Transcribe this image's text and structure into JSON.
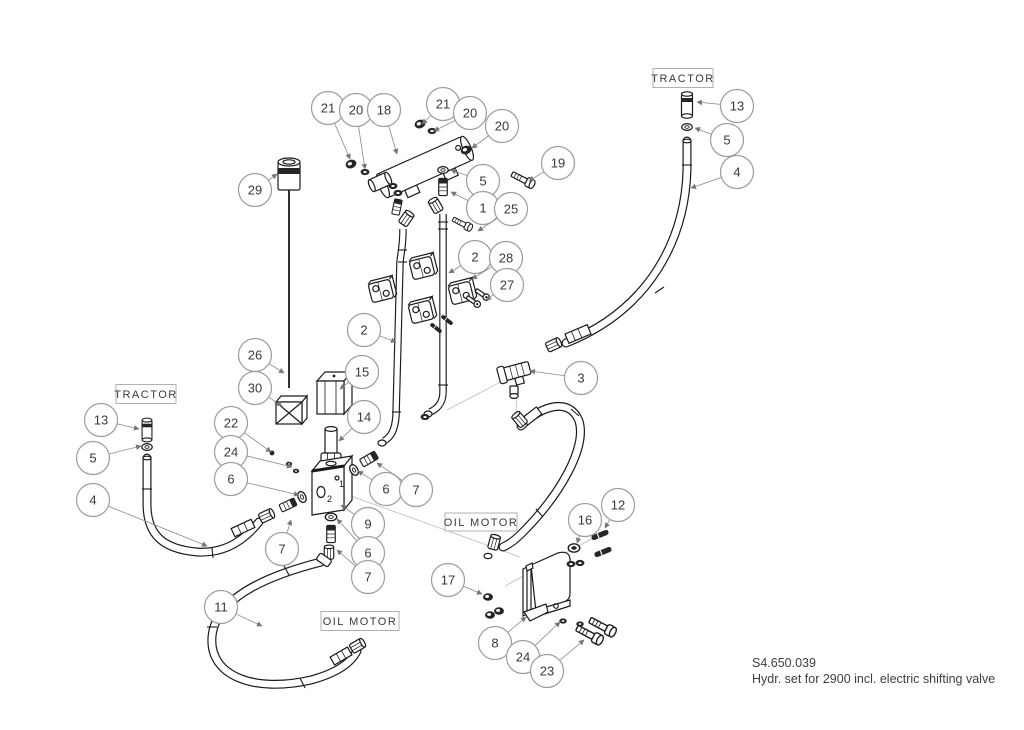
{
  "drawing": {
    "code": "S4.650.039",
    "description": "Hydr. set for 2900 incl. electric shifting valve"
  },
  "boxes": [
    {
      "text": "TRACTOR",
      "cx": 683,
      "cy": 78,
      "w": 60,
      "h": 19
    },
    {
      "text": "TRACTOR",
      "cx": 146,
      "cy": 394,
      "w": 60,
      "h": 19
    },
    {
      "text": "OIL MOTOR",
      "cx": 481,
      "cy": 522,
      "w": 72,
      "h": 18
    },
    {
      "text": "OIL MOTOR",
      "cx": 360,
      "cy": 621,
      "w": 78,
      "h": 19
    }
  ],
  "valve_block_port_marks": [
    "1",
    "2"
  ],
  "callouts": [
    {
      "n": "21",
      "x": 328,
      "y": 108,
      "tx": 350,
      "ty": 159
    },
    {
      "n": "20",
      "x": 356,
      "y": 110,
      "tx": 365,
      "ty": 169
    },
    {
      "n": "18",
      "x": 384,
      "y": 110,
      "tx": 397,
      "ty": 154
    },
    {
      "n": "21",
      "x": 443,
      "y": 104,
      "tx": 422,
      "ty": 124
    },
    {
      "n": "20",
      "x": 470,
      "y": 113,
      "tx": 434,
      "ty": 131
    },
    {
      "n": "20",
      "x": 502,
      "y": 126,
      "tx": 472,
      "ty": 148
    },
    {
      "n": "19",
      "x": 558,
      "y": 163,
      "tx": 529,
      "ty": 181
    },
    {
      "n": "5",
      "x": 483,
      "y": 181,
      "tx": 451,
      "ty": 170
    },
    {
      "n": "1",
      "x": 483,
      "y": 208,
      "tx": 451,
      "ty": 192
    },
    {
      "n": "25",
      "x": 511,
      "y": 209,
      "tx": 478,
      "ty": 231
    },
    {
      "n": "13",
      "x": 737,
      "y": 106,
      "tx": 697,
      "ty": 102
    },
    {
      "n": "5",
      "x": 727,
      "y": 140,
      "tx": 695,
      "ty": 128
    },
    {
      "n": "4",
      "x": 737,
      "y": 172,
      "tx": 691,
      "ty": 188
    },
    {
      "n": "29",
      "x": 255,
      "y": 190,
      "tx": 277,
      "ty": 174
    },
    {
      "n": "2",
      "x": 475,
      "y": 257,
      "tx": 449,
      "ty": 273
    },
    {
      "n": "28",
      "x": 506,
      "y": 258,
      "tx": 472,
      "ty": 279
    },
    {
      "n": "27",
      "x": 507,
      "y": 285,
      "tx": 486,
      "ty": 300
    },
    {
      "n": "2",
      "x": 364,
      "y": 330,
      "tx": 396,
      "ty": 342
    },
    {
      "n": "3",
      "x": 581,
      "y": 378,
      "tx": 530,
      "ty": 371
    },
    {
      "n": "26",
      "x": 255,
      "y": 355,
      "tx": 284,
      "ty": 373
    },
    {
      "n": "30",
      "x": 255,
      "y": 388,
      "tx": 282,
      "ty": 406
    },
    {
      "n": "13",
      "x": 101,
      "y": 420,
      "tx": 139,
      "ty": 429
    },
    {
      "n": "5",
      "x": 93,
      "y": 458,
      "tx": 141,
      "ty": 446
    },
    {
      "n": "4",
      "x": 93,
      "y": 500,
      "tx": 207,
      "ty": 546
    },
    {
      "n": "22",
      "x": 231,
      "y": 423,
      "tx": 271,
      "ty": 452
    },
    {
      "n": "24",
      "x": 231,
      "y": 452,
      "tx": 292,
      "ty": 467
    },
    {
      "n": "6",
      "x": 231,
      "y": 479,
      "tx": 299,
      "ty": 495
    },
    {
      "n": "7",
      "x": 282,
      "y": 549,
      "tx": 291,
      "ty": 520
    },
    {
      "n": "15",
      "x": 362,
      "y": 372,
      "tx": 340,
      "ty": 389
    },
    {
      "n": "14",
      "x": 364,
      "y": 417,
      "tx": 339,
      "ty": 441
    },
    {
      "n": "6",
      "x": 386,
      "y": 489,
      "tx": 358,
      "ty": 471
    },
    {
      "n": "7",
      "x": 416,
      "y": 490,
      "tx": 377,
      "ty": 463
    },
    {
      "n": "9",
      "x": 368,
      "y": 524,
      "tx": 341,
      "ty": 505
    },
    {
      "n": "6",
      "x": 368,
      "y": 553,
      "tx": 337,
      "ty": 519
    },
    {
      "n": "7",
      "x": 368,
      "y": 577,
      "tx": 337,
      "ty": 550
    },
    {
      "n": "11",
      "x": 221,
      "y": 607,
      "tx": 262,
      "ty": 626
    },
    {
      "n": "16",
      "x": 585,
      "y": 520,
      "tx": 577,
      "ty": 543
    },
    {
      "n": "12",
      "x": 618,
      "y": 505,
      "tx": 605,
      "ty": 528
    },
    {
      "n": "17",
      "x": 448,
      "y": 580,
      "tx": 482,
      "ty": 594
    },
    {
      "n": "8",
      "x": 495,
      "y": 643,
      "tx": 526,
      "ty": 617
    },
    {
      "n": "24",
      "x": 523,
      "y": 657,
      "tx": 560,
      "ty": 622
    },
    {
      "n": "23",
      "x": 547,
      "y": 671,
      "tx": 584,
      "ty": 640
    }
  ]
}
